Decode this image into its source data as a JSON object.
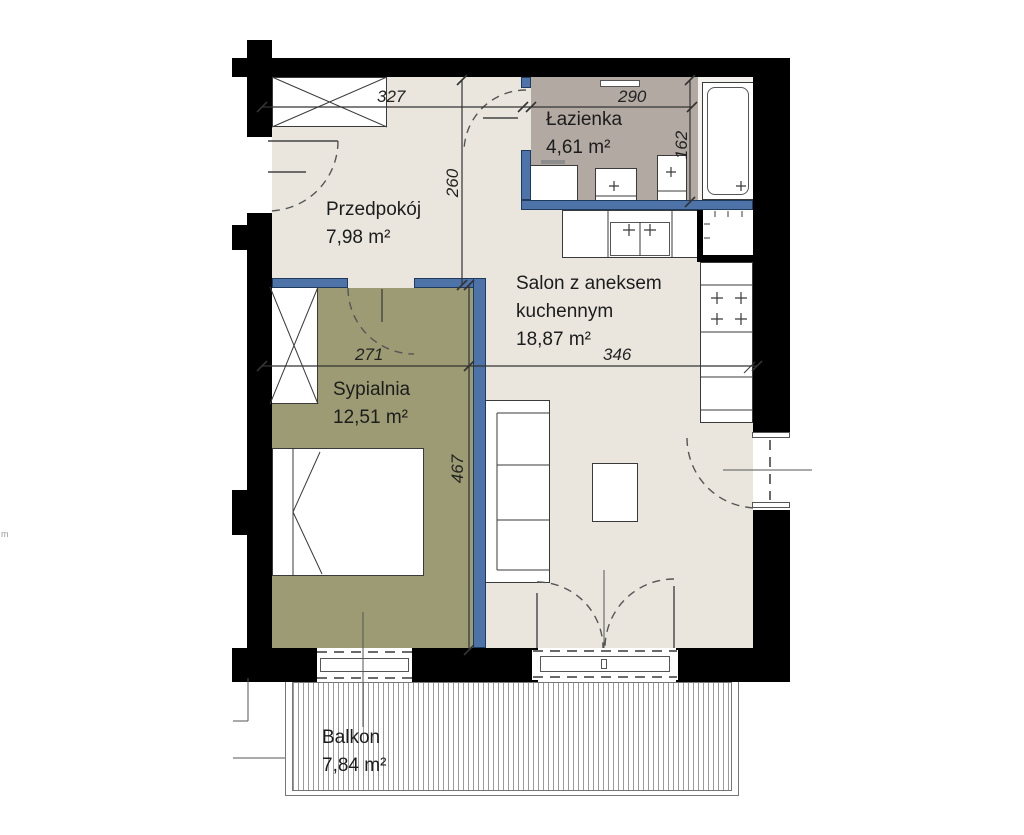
{
  "rooms": {
    "hallway": {
      "label": "Przedpokój",
      "area": "7,98 m²"
    },
    "bathroom": {
      "label": "Łazienka",
      "area": "4,61 m²"
    },
    "living_room": {
      "label_line1": "Salon z aneksem",
      "label_line2": "kuchennym",
      "area": "18,87 m²"
    },
    "bedroom": {
      "label": "Sypialnia",
      "area": "12,51 m²"
    },
    "balcony": {
      "label": "Balkon",
      "area": "7,84 m²"
    }
  },
  "dimensions_cm": {
    "hallway_width": "327",
    "hallway_depth": "260",
    "bathroom_width": "290",
    "bathroom_depth": "162",
    "bedroom_width": "271",
    "bedroom_depth": "467",
    "living_room_width": "346"
  },
  "edge_label": "m",
  "colors": {
    "structural_wall": "#000000",
    "partition_wall": "#4d73a9",
    "hallway_floor": "#eae6de",
    "living_floor": "#eae6de",
    "bedroom_floor": "#9c9b74",
    "bathroom_floor": "#b2aaa2",
    "balcony_hatch_line": "#9a9a9a"
  }
}
